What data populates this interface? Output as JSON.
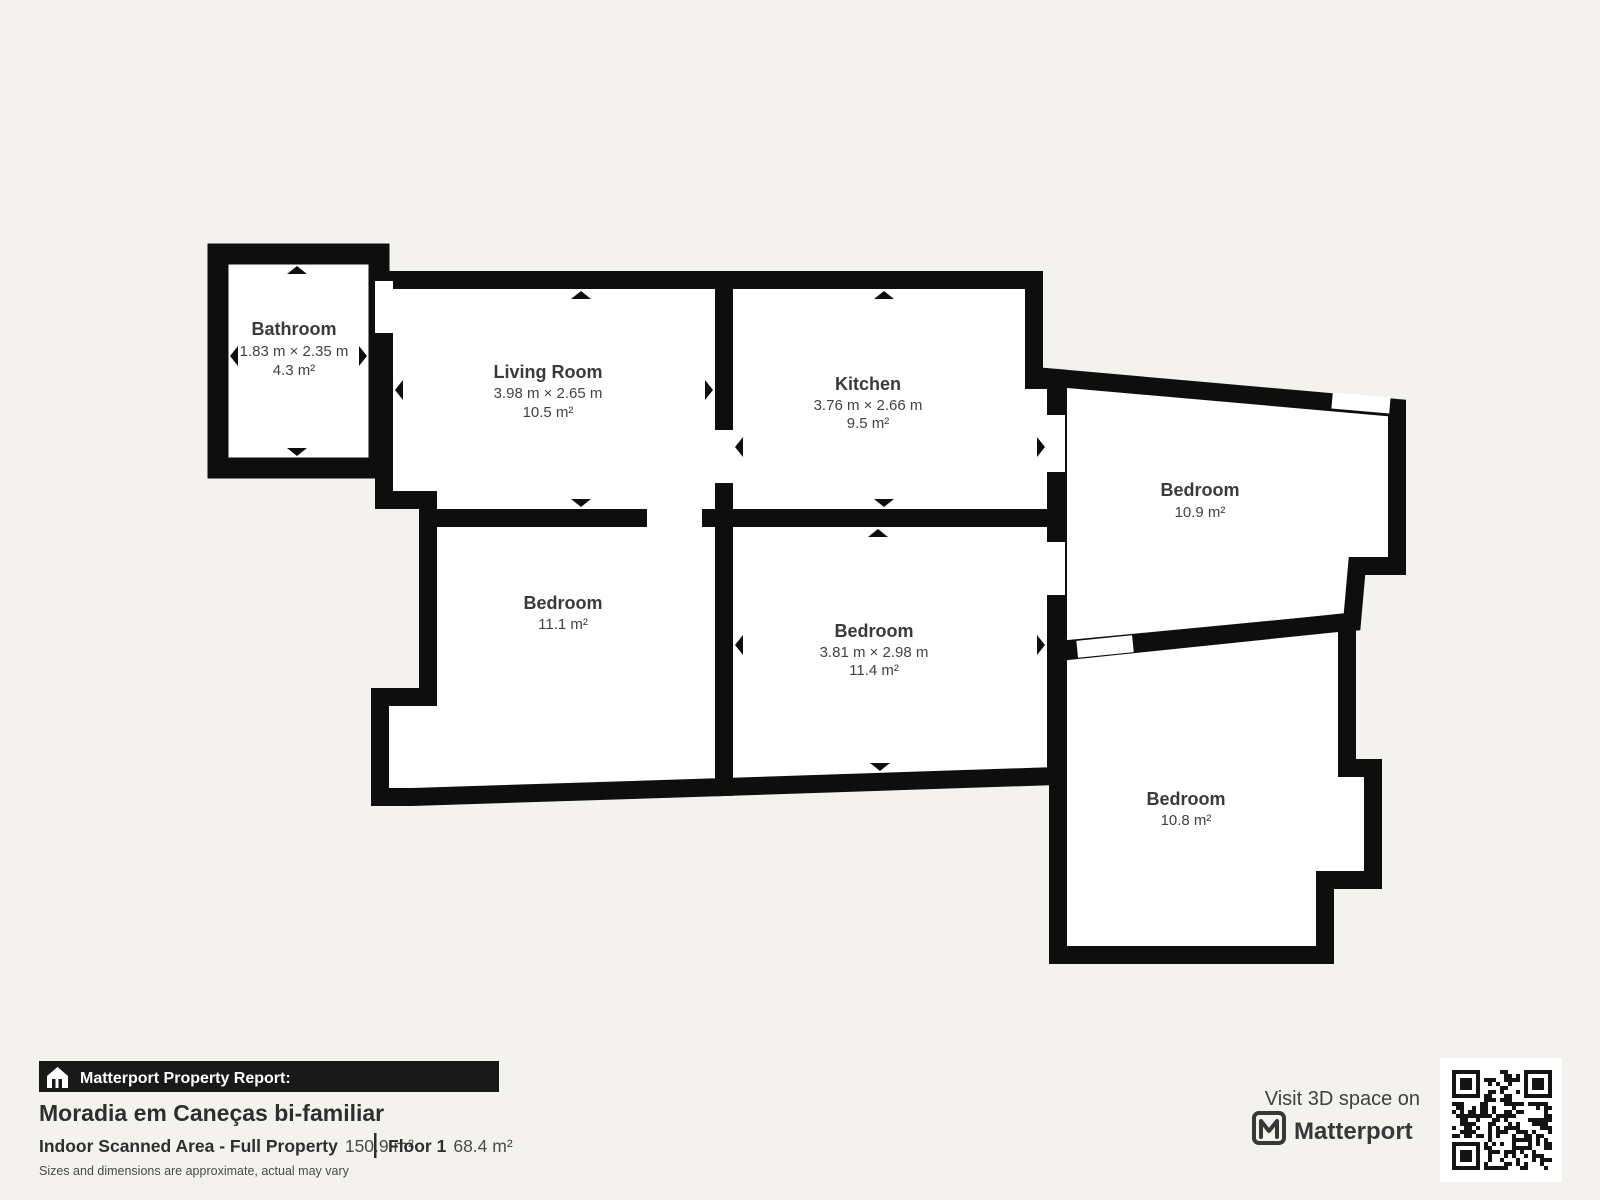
{
  "colors": {
    "background": "#f4f2ef",
    "wall": "#0e0e0e",
    "room_fill": "#ffffff",
    "label_text": "#3a3a3a",
    "banner_bg": "#191919",
    "banner_text": "#ffffff"
  },
  "floorplan": {
    "rooms": [
      {
        "id": "bathroom",
        "name": "Bathroom",
        "dims": "1.83 m × 2.35 m",
        "area": "4.3 m²"
      },
      {
        "id": "living-room",
        "name": "Living Room",
        "dims": "3.98 m × 2.65 m",
        "area": "10.5 m²"
      },
      {
        "id": "kitchen",
        "name": "Kitchen",
        "dims": "3.76 m × 2.66 m",
        "area": "9.5 m²"
      },
      {
        "id": "bedroom-top-right",
        "name": "Bedroom",
        "area": "10.9 m²"
      },
      {
        "id": "bedroom-bottom-left",
        "name": "Bedroom",
        "area": "11.1 m²"
      },
      {
        "id": "bedroom-middle",
        "name": "Bedroom",
        "dims": "3.81 m × 2.98 m",
        "area": "11.4 m²"
      },
      {
        "id": "bedroom-bottom-right",
        "name": "Bedroom",
        "area": "10.8 m²"
      }
    ]
  },
  "report": {
    "banner_label": "Matterport Property Report:",
    "property_title": "Moradia em Caneças bi-familiar",
    "area_label": "Indoor Scanned Area - Full Property",
    "area_value": "150.9 m²",
    "floor_label": "Floor 1",
    "floor_value": "68.4 m²",
    "disclaimer": "Sizes and dimensions are approximate, actual may vary"
  },
  "cta": {
    "visit_label": "Visit 3D space on",
    "brand": "Matterport"
  }
}
